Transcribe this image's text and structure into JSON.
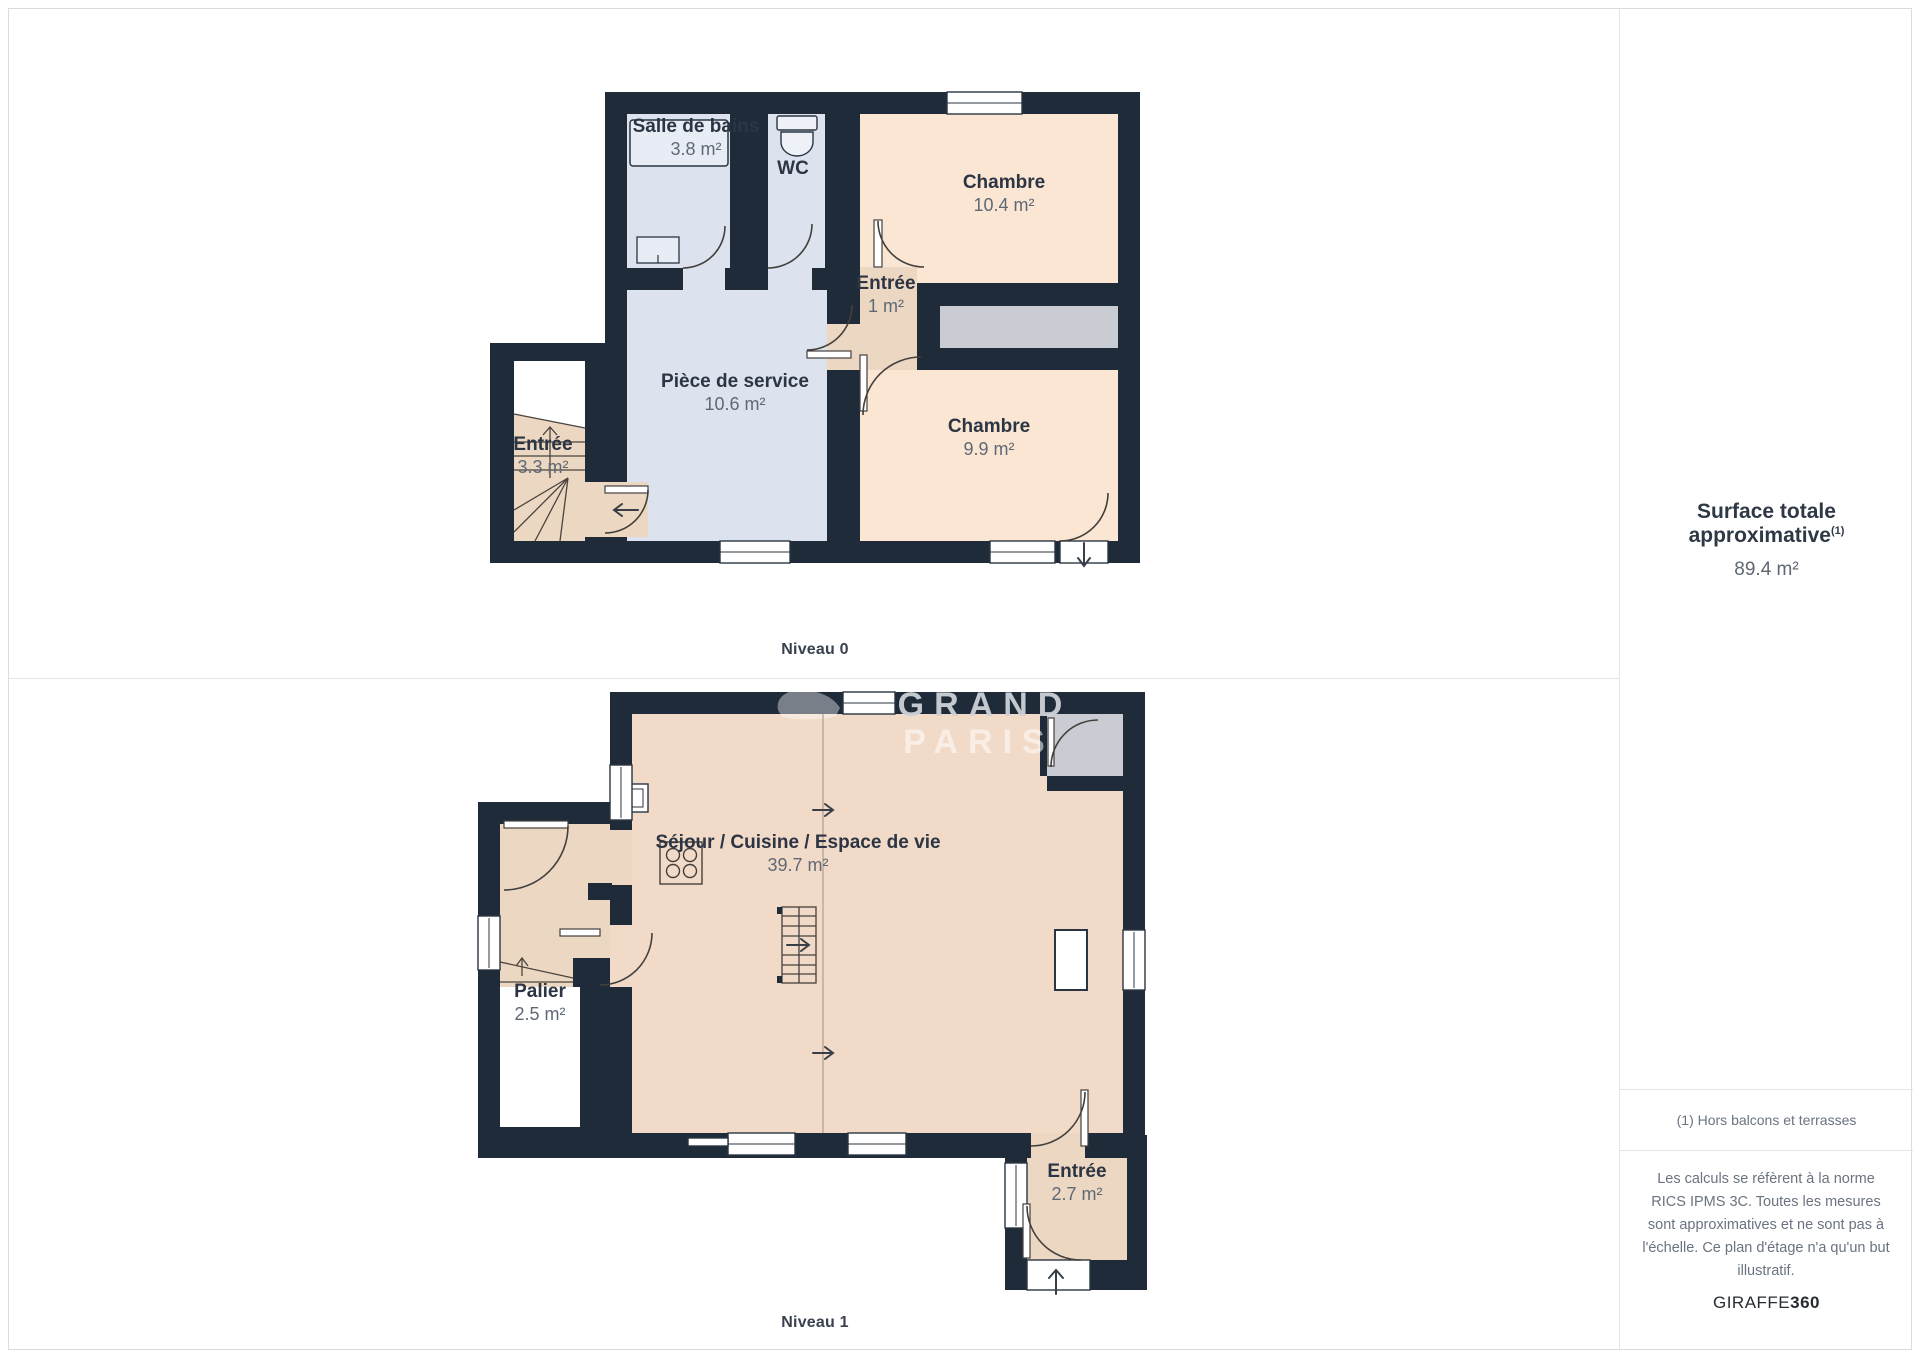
{
  "sidebar": {
    "surface_title": "Surface totale approximative",
    "surface_sup": "(1)",
    "surface_value": "89.4 m²",
    "footnote": "(1) Hors balcons et terrasses",
    "disclaimer": "Les calculs se réfèrent à la norme RICS IPMS 3C. Toutes les mesures sont approximatives et ne sont pas à l'échelle. Ce plan d'étage n'a qu'un but illustratif.",
    "brand_regular": "GIRAFFE",
    "brand_bold": "360"
  },
  "watermark": {
    "line1": "GRAND",
    "line2": "PARIS"
  },
  "levels": [
    {
      "label": "Niveau 0",
      "rooms": [
        {
          "name": "Salle de bains",
          "area": "3.8 m²"
        },
        {
          "name": "WC",
          "area": ""
        },
        {
          "name": "Chambre",
          "area": "10.4 m²"
        },
        {
          "name": "Entrée",
          "area": "1 m²"
        },
        {
          "name": "Pièce de service",
          "area": "10.6 m²"
        },
        {
          "name": "Entrée",
          "area": "3.3 m²"
        },
        {
          "name": "Chambre",
          "area": "9.9 m²"
        }
      ]
    },
    {
      "label": "Niveau 1",
      "rooms": [
        {
          "name": "Séjour / Cuisine / Espace de vie",
          "area": "39.7 m²"
        },
        {
          "name": "Palier",
          "area": "2.5 m²"
        },
        {
          "name": "Entrée",
          "area": "2.7 m²"
        }
      ]
    }
  ],
  "colors": {
    "wall": "#1f2b39",
    "room_blue": "#dce3ef",
    "room_peach": "#fbe6d4",
    "room_tan": "#ecd7c2",
    "room_living": "#f2dac8",
    "area_gray": "#c9cdd3",
    "label_dark": "#2c3543",
    "label_gray": "#5f6975"
  }
}
